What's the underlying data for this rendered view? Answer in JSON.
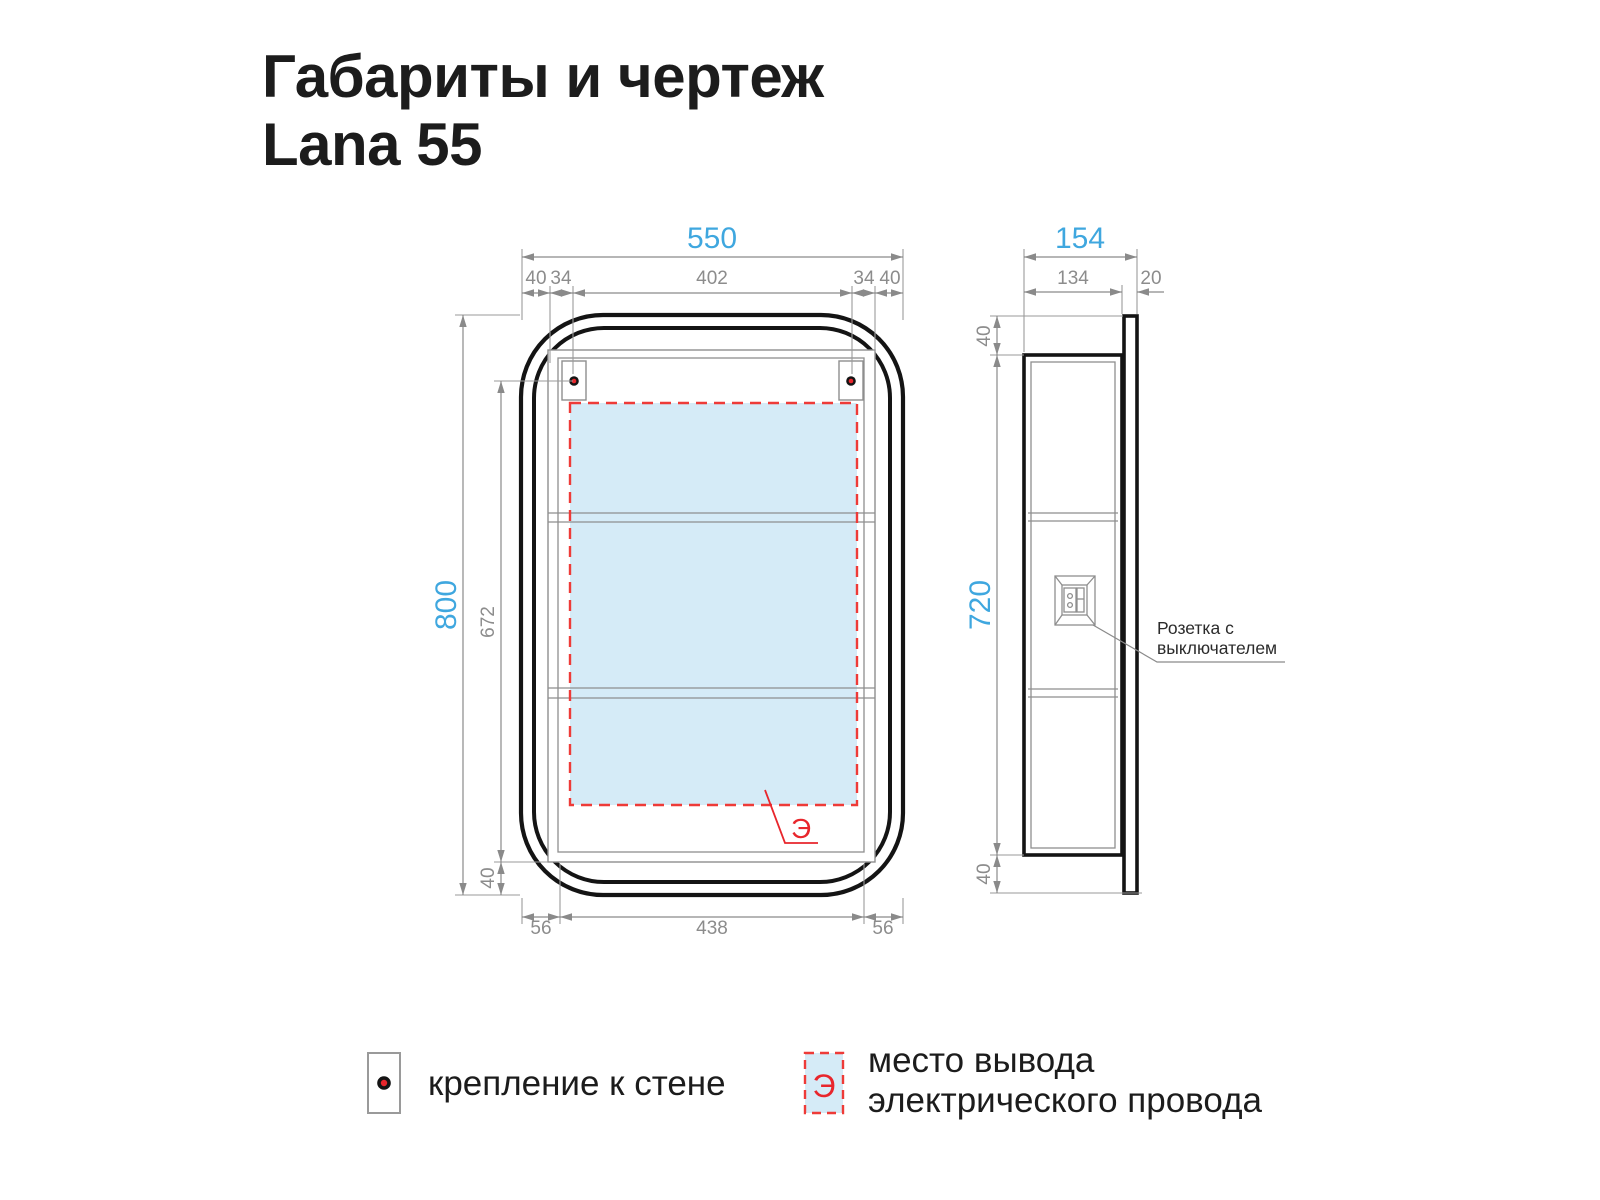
{
  "title": {
    "line1": "Габариты и чертеж",
    "line2": "Lana 55"
  },
  "front_view": {
    "dim_width_total": "550",
    "dim_top_margin_left": "40",
    "dim_top_bracket_left": "34",
    "dim_top_center": "402",
    "dim_top_bracket_right": "34",
    "dim_top_margin_right": "40",
    "dim_height_total": "800",
    "dim_height_inner": "672",
    "dim_height_bottom": "40",
    "dim_bottom_left": "56",
    "dim_bottom_center": "438",
    "dim_bottom_right": "56",
    "electric_mark": "Э"
  },
  "side_view": {
    "dim_depth_total": "154",
    "dim_depth_body": "134",
    "dim_depth_door": "20",
    "dim_top_offset": "40",
    "dim_body_height": "720",
    "dim_bottom_offset": "40",
    "socket_label_line1": "Розетка с",
    "socket_label_line2": "выключателем"
  },
  "legend": {
    "mount_label": "крепление к стене",
    "electric_symbol": "Э",
    "electric_label_line1": "место вывода",
    "electric_label_line2": "электрического провода"
  },
  "colors": {
    "accent_blue": "#3FA7DF",
    "dim_gray": "#8C8C8C",
    "red": "#E8262C",
    "dash_red": "#EE3B38",
    "light_blue_fill": "#D5EBF7",
    "line_black": "#141414"
  }
}
